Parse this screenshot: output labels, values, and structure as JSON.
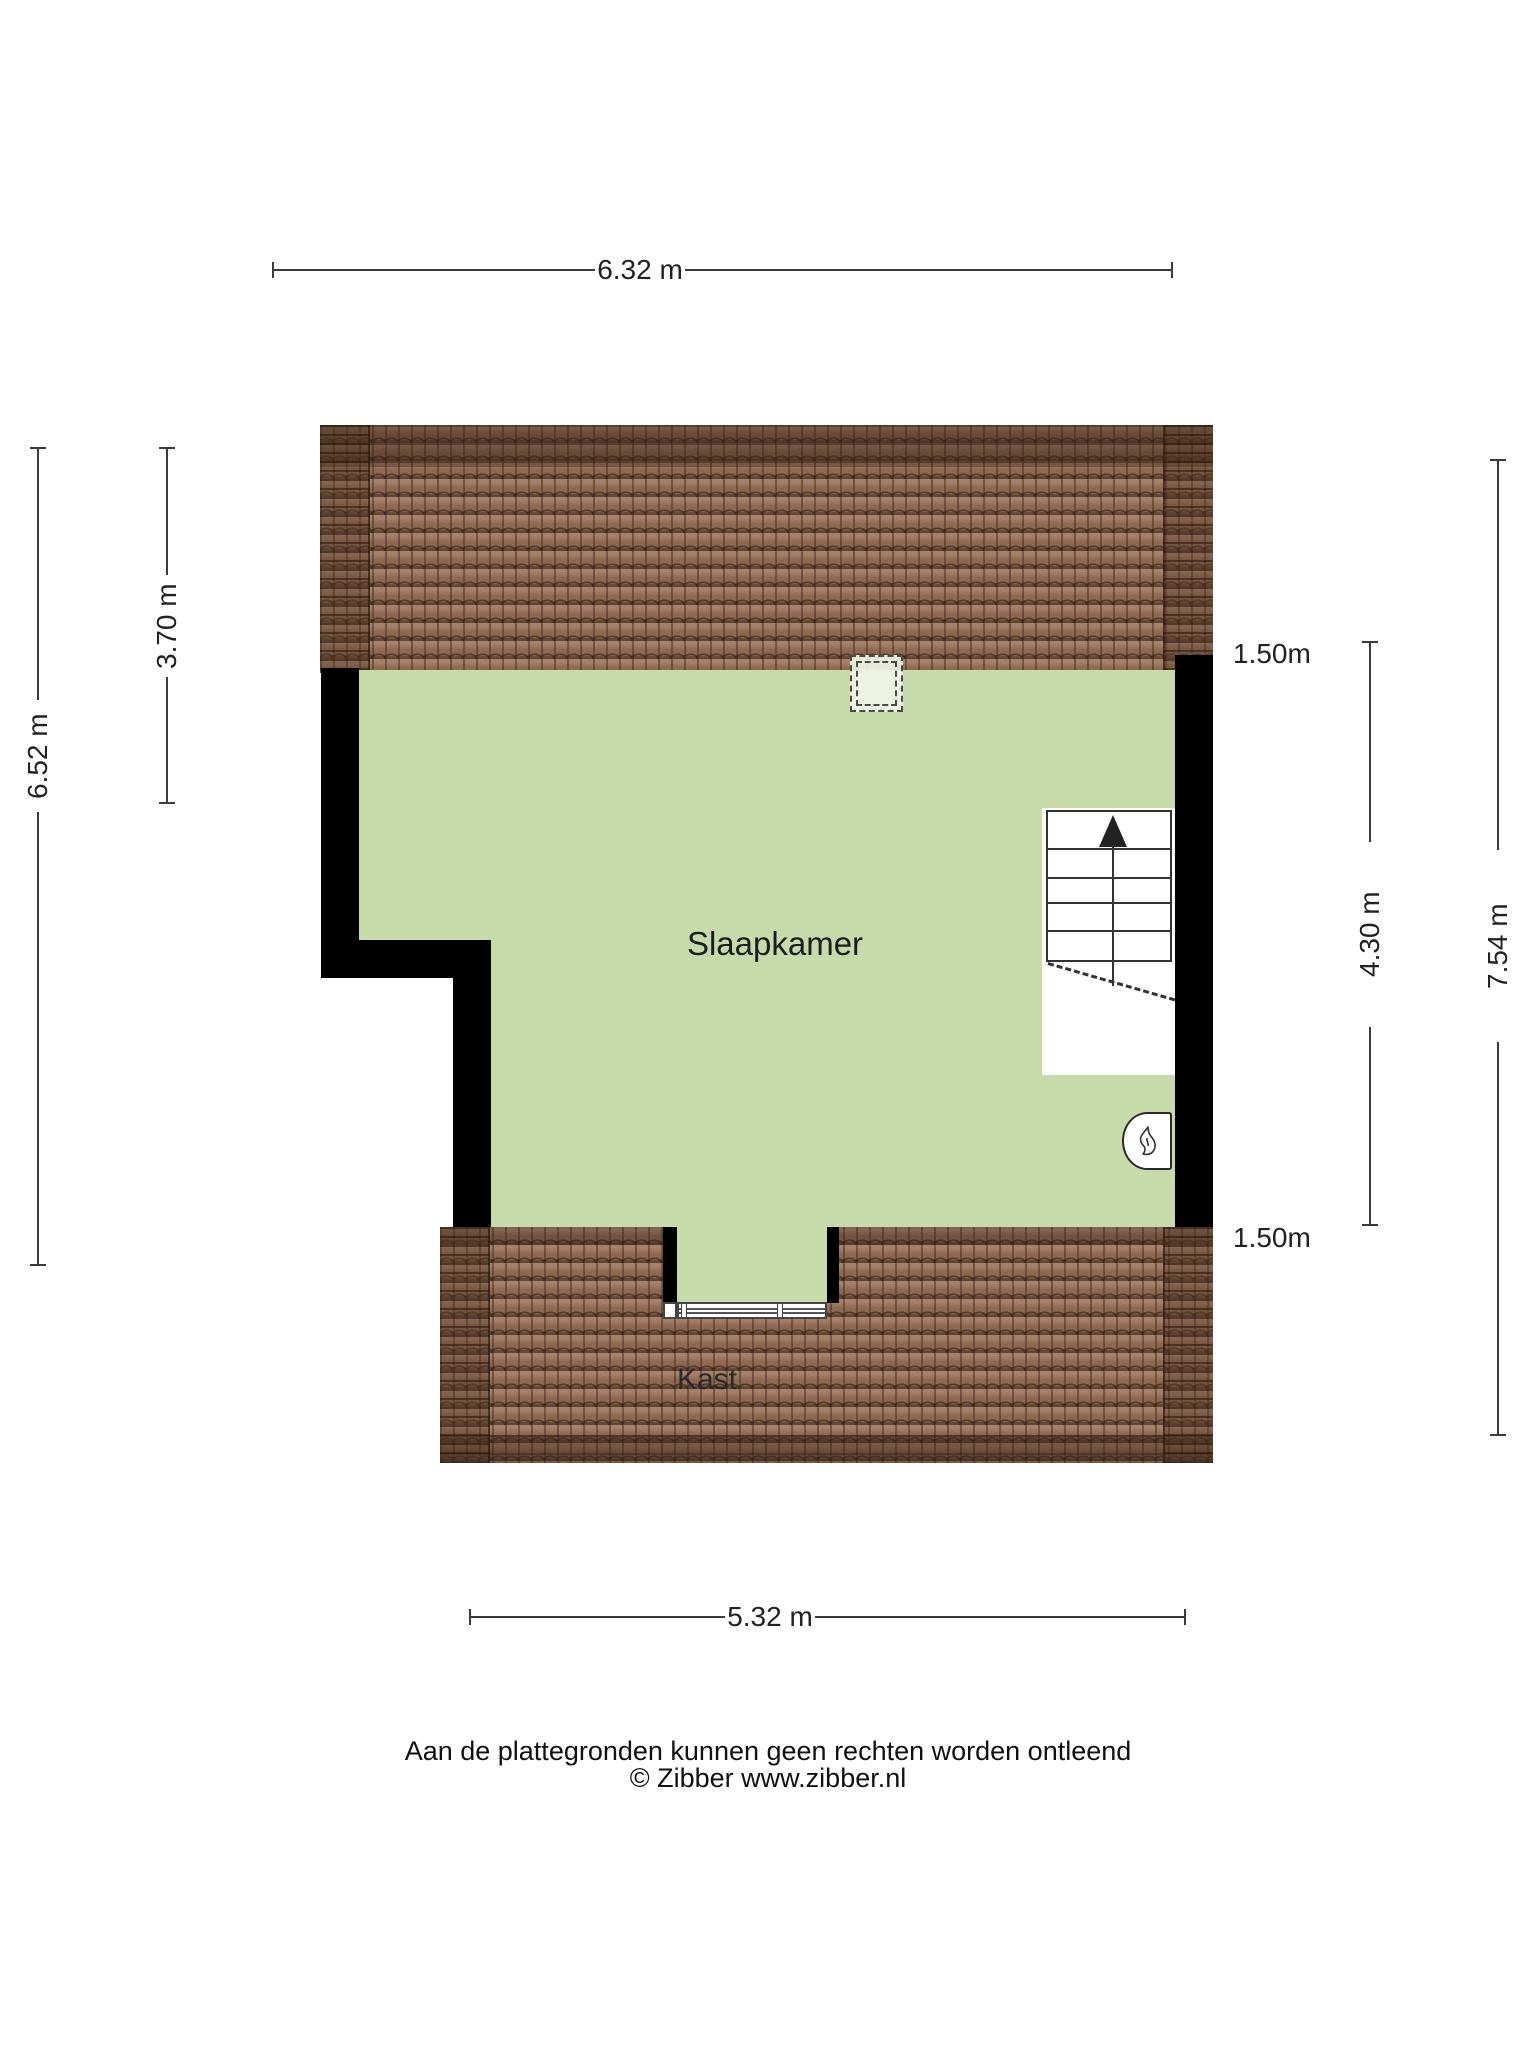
{
  "plan": {
    "type": "floorplan-attic",
    "rooms": {
      "bedroom": {
        "label": "Slaapkamer"
      },
      "closet": {
        "label": "Kast"
      }
    },
    "dimensions": {
      "top": {
        "label": "6.32 m"
      },
      "left_outer": {
        "label": "6.52 m"
      },
      "left_inner": {
        "label": "3.70 m"
      },
      "right_knee_top": {
        "label": "1.50m"
      },
      "right_inner": {
        "label": "4.30 m"
      },
      "right_outer": {
        "label": "7.54 m"
      },
      "right_knee_bottom": {
        "label": "1.50m"
      },
      "bottom": {
        "label": "5.32 m"
      }
    },
    "icons": {
      "stairs_up_arrow": "stairs-direction-up",
      "boiler_flame": "flame",
      "skylight": "dashed-roof-window"
    },
    "colors": {
      "room_fill": "#c6dba9",
      "roof_tile": "#9a7158",
      "roof_ridge": "#7c573f",
      "wall": "#000000",
      "skylight_fill": "#eef3e0",
      "dimension_line": "#3b3b3b"
    }
  },
  "footer": {
    "disclaimer": "Aan de plattegronden kunnen geen rechten worden ontleend",
    "copyright": "© Zibber www.zibber.nl"
  }
}
